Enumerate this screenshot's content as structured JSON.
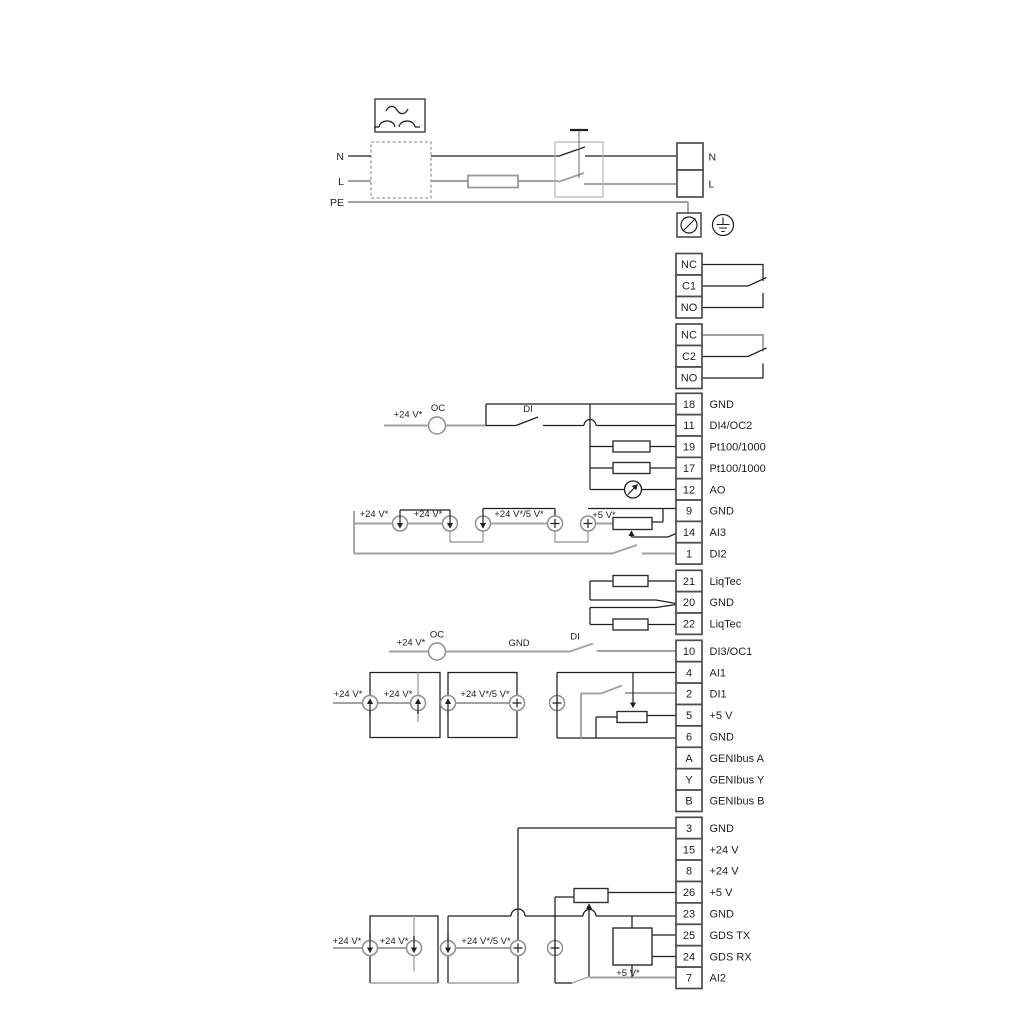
{
  "power": {
    "input_labels": [
      "N",
      "L",
      "PE"
    ],
    "output_terminals": [
      "N",
      "L"
    ]
  },
  "relays": [
    {
      "terminals": [
        "NC",
        "C1",
        "NO"
      ]
    },
    {
      "terminals": [
        "NC",
        "C2",
        "NO"
      ]
    }
  ],
  "terminal_blocks": [
    {
      "id": "io-block-1",
      "rows": [
        {
          "num": "18",
          "label": "GND"
        },
        {
          "num": "11",
          "label": "DI4/OC2"
        },
        {
          "num": "19",
          "label": "Pt100/1000"
        },
        {
          "num": "17",
          "label": "Pt100/1000"
        },
        {
          "num": "12",
          "label": "AO"
        },
        {
          "num": "9",
          "label": "GND"
        },
        {
          "num": "14",
          "label": "AI3"
        },
        {
          "num": "1",
          "label": "DI2"
        }
      ]
    },
    {
      "id": "liqtec-block",
      "rows": [
        {
          "num": "21",
          "label": "LiqTec"
        },
        {
          "num": "20",
          "label": "GND"
        },
        {
          "num": "22",
          "label": "LiqTec"
        }
      ]
    },
    {
      "id": "io-block-2",
      "rows": [
        {
          "num": "10",
          "label": "DI3/OC1"
        },
        {
          "num": "4",
          "label": "AI1"
        },
        {
          "num": "2",
          "label": "DI1"
        },
        {
          "num": "5",
          "label": "+5 V"
        },
        {
          "num": "6",
          "label": "GND"
        },
        {
          "num": "A",
          "label": "GENIbus A"
        },
        {
          "num": "Y",
          "label": "GENIbus Y"
        },
        {
          "num": "B",
          "label": "GENIbus B"
        }
      ]
    },
    {
      "id": "io-block-3",
      "rows": [
        {
          "num": "3",
          "label": "GND"
        },
        {
          "num": "15",
          "label": "+24 V"
        },
        {
          "num": "8",
          "label": "+24 V"
        },
        {
          "num": "26",
          "label": "+5 V"
        },
        {
          "num": "23",
          "label": "GND"
        },
        {
          "num": "25",
          "label": "GDS TX"
        },
        {
          "num": "24",
          "label": "GDS RX"
        },
        {
          "num": "7",
          "label": "AI2"
        }
      ]
    }
  ],
  "inline_labels": {
    "plus24": "+24 V*",
    "plus24_or_5": "+24 V*/5 V*",
    "plus5": "+5 V*",
    "oc": "OC",
    "di": "DI",
    "gnd": "GND"
  },
  "colors": {
    "wire_dark": "#1f1f1f",
    "wire_gray": "#a2a2a2",
    "terminal_border": "#4d4d4d",
    "background": "#ffffff"
  }
}
